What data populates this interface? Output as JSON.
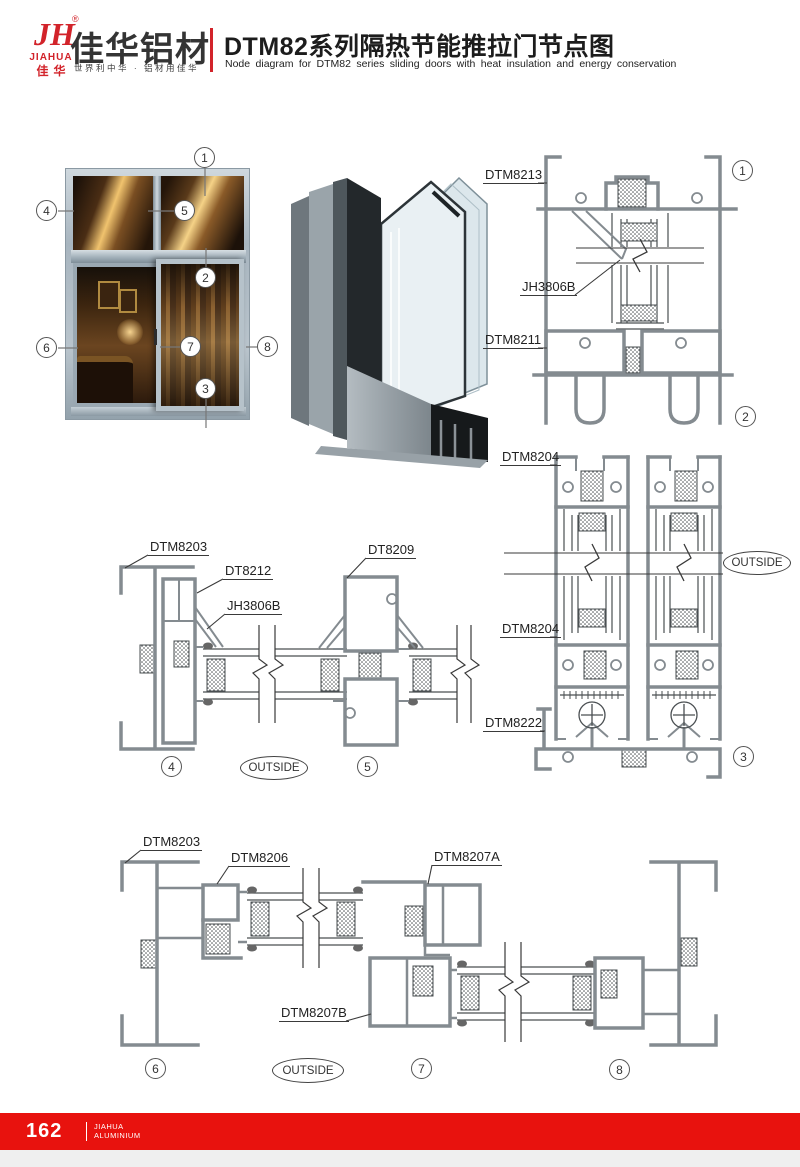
{
  "header": {
    "logo": {
      "monogram": "JH",
      "registered": "®",
      "brand_en": "JIAHUA",
      "brand_cn": "佳华",
      "company": "佳华铝材",
      "tagline": "世界利中华 · 铝材用佳华"
    },
    "title_cn": "DTM82系列隔热节能推拉门节点图",
    "title_en": "Node diagram for DTM82 series sliding doors with heat insulation and energy conservation"
  },
  "photo_callouts": {
    "c1": "1",
    "c2": "2",
    "c3": "3",
    "c4": "4",
    "c5": "5",
    "c6": "6",
    "c7": "7",
    "c8": "8"
  },
  "right_section": {
    "dtm8213": "DTM8213",
    "jh3806b": "JH3806B",
    "dtm8211": "DTM8211",
    "dtm8204_top": "DTM8204",
    "outside": "OUTSIDE",
    "dtm8204_bottom": "DTM8204",
    "dtm8222": "DTM8222",
    "c1": "1",
    "c2": "2",
    "c3": "3"
  },
  "mid_section": {
    "dtm8203": "DTM8203",
    "dt8212": "DT8212",
    "jh3806b": "JH3806B",
    "dt8209": "DT8209",
    "outside": "OUTSIDE",
    "c4": "4",
    "c5": "5"
  },
  "bottom_section": {
    "dtm8203": "DTM8203",
    "dtm8206": "DTM8206",
    "dtm8207a": "DTM8207A",
    "dtm8207b": "DTM8207B",
    "outside": "OUTSIDE",
    "c6": "6",
    "c7": "7",
    "c8": "8"
  },
  "footer": {
    "page": "162",
    "brand_line1": "JIAHUA",
    "brand_line2": "ALUMINIUM"
  }
}
